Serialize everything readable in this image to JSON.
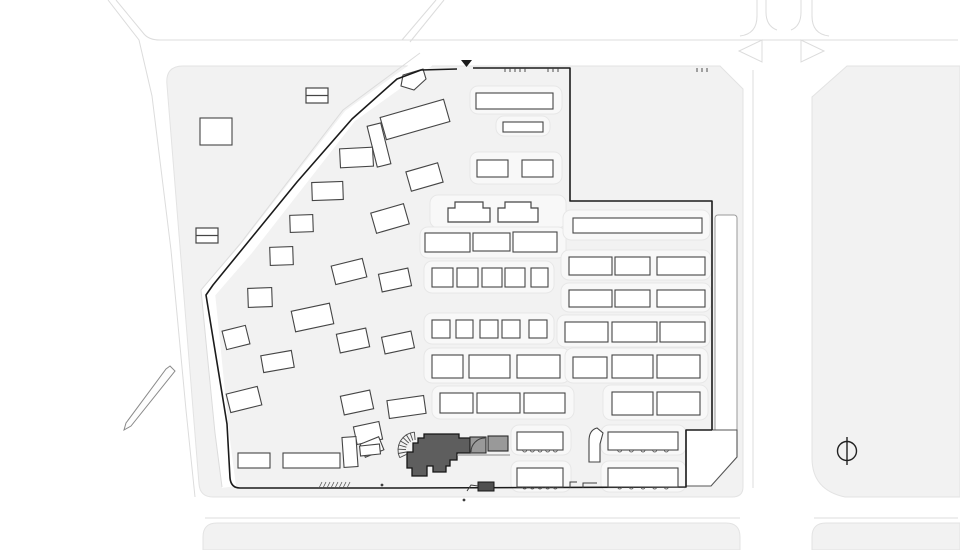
{
  "title": "architectural site plan",
  "colors": {
    "background": "#ffffff",
    "block": "#f2f2f2",
    "block_edge": "#e3e3e3",
    "corridor": "#f8f8f8",
    "corridor_edge": "#e7e7e7",
    "road_edge": "#dcdcdc",
    "building_fill": "#ffffff",
    "building_stroke": "#454545",
    "parcel_stroke": "#9a9a9a",
    "boundary": "#1b1b1b",
    "highlight_fill": "#5e5e5e",
    "highlight_stroke": "#161616",
    "annex_fill": "#999999",
    "detail": "#3d3d3d",
    "north": "#222222"
  },
  "plan": {
    "canvas": {
      "w": 960,
      "h": 550
    },
    "blocks": [
      "M183,66 H720 L743,89 V487 Q743,497 732,497 H213 Q200,497 199,484 L167,85 Q165,66 183,66 Z",
      "M847,66 L812,97 V458 Q812,490 845,497 H960 V66 Z",
      "M203,550 V537 Q203,523 217,523 H726 Q740,523 740,537 V550 Z",
      "M812,550 V537 Q812,523 826,523 H960 V550 Z"
    ],
    "diag_road": {
      "band": "M428,60 L350,116 L247,248 L208,293 L214,352 L222,432 L229,487",
      "curb": "M420,53 L343,110 L240,244 L201,290 L207,352 L215,433 L222,487"
    },
    "road_lines": [
      "M116,0 L144,34 Q149,40 160,40 L958,40",
      "M108,0 L139,40 L152,96 L171,250 L186,410 L195,497",
      "M436,0 L402,40",
      "M444,0 L410,42",
      "M757,0 V16 Q757,34 740,36",
      "M812,0 V16 Q812,34 829,36",
      "M766,0 V12 Q766,26 777,30",
      "M801,0 V12 Q801,26 791,30",
      "M753,70 V488",
      "M205,518 H740",
      "M814,518 H958"
    ],
    "islands": [
      "762,40 762,62 739,51",
      "801,40 801,62 824,51"
    ],
    "corridors": [
      [
        470,
        86,
        92,
        28
      ],
      [
        496,
        116,
        54,
        20
      ],
      [
        470,
        152,
        92,
        32
      ],
      [
        430,
        195,
        136,
        33
      ],
      [
        420,
        227,
        146,
        31
      ],
      [
        424,
        261,
        130,
        32
      ],
      [
        424,
        313,
        130,
        31
      ],
      [
        424,
        348,
        146,
        35
      ],
      [
        432,
        386,
        142,
        33
      ],
      [
        563,
        210,
        147,
        30
      ],
      [
        561,
        250,
        150,
        30
      ],
      [
        561,
        283,
        150,
        29
      ],
      [
        557,
        315,
        153,
        32
      ],
      [
        565,
        348,
        143,
        35
      ],
      [
        603,
        385,
        105,
        35
      ],
      [
        511,
        425,
        60,
        30
      ],
      [
        601,
        425,
        85,
        30
      ],
      [
        511,
        461,
        60,
        31
      ],
      [
        601,
        461,
        85,
        31
      ]
    ],
    "parcel_strip": [
      715,
      215,
      22,
      217
    ],
    "parcel_pentagon": "686,430 737,430 737,457 711,486 686,486",
    "wall_sliver": "170,366 175,371 131,426 124,430 126,423 166,369",
    "gate_building": "401,86 403,75 423,69 426,79 414,90",
    "hook_building": "M589,462 L589,441 Q589,430 597,428 L603,433 L600,444 L600,462 Z",
    "site_boundary": [
      "M421,70 L457,69",
      "M473,68 L570,68 L570,201 L712,201 L712,430",
      "M712,430 H686 V487 L400,488",
      "M400,488 L240,488 Q231,488 230,478 L227,424 L206,295 L213,285 L297,182 L352,119 L397,79 L421,70"
    ],
    "entrance_marker": "461,60 472,60 466.5,67",
    "boundary_ticks": [
      505,
      510,
      515,
      520,
      525,
      548,
      553,
      558,
      697,
      702,
      707
    ],
    "hatch": {
      "x": 322,
      "y": 482,
      "n": 8,
      "step": 4,
      "drop": 6
    },
    "jogs": [
      "M570,488 V482 H577",
      "M583,488 V483 H597"
    ],
    "buildings_grid": [
      [
        200,
        118,
        32,
        27
      ],
      [
        476,
        93,
        77,
        16
      ],
      [
        503,
        122,
        40,
        10
      ],
      [
        477,
        160,
        31,
        17
      ],
      [
        522,
        160,
        31,
        17
      ],
      [
        425,
        233,
        45,
        19
      ],
      [
        473,
        233,
        37,
        18
      ],
      [
        513,
        232,
        44,
        20
      ],
      [
        432,
        268,
        21,
        19
      ],
      [
        457,
        268,
        21,
        19
      ],
      [
        482,
        268,
        20,
        19
      ],
      [
        505,
        268,
        20,
        19
      ],
      [
        531,
        268,
        17,
        19
      ],
      [
        432,
        320,
        18,
        18
      ],
      [
        456,
        320,
        17,
        18
      ],
      [
        480,
        320,
        18,
        18
      ],
      [
        502,
        320,
        18,
        18
      ],
      [
        529,
        320,
        18,
        18
      ],
      [
        432,
        355,
        31,
        23
      ],
      [
        469,
        355,
        41,
        23
      ],
      [
        517,
        355,
        43,
        23
      ],
      [
        440,
        393,
        33,
        20
      ],
      [
        477,
        393,
        43,
        20
      ],
      [
        524,
        393,
        41,
        20
      ],
      [
        573,
        218,
        129,
        15
      ],
      [
        569,
        257,
        43,
        18
      ],
      [
        615,
        257,
        35,
        18
      ],
      [
        657,
        257,
        48,
        18
      ],
      [
        569,
        290,
        43,
        17
      ],
      [
        615,
        290,
        35,
        17
      ],
      [
        657,
        290,
        48,
        17
      ],
      [
        565,
        322,
        43,
        20
      ],
      [
        612,
        322,
        45,
        20
      ],
      [
        660,
        322,
        45,
        20
      ],
      [
        573,
        357,
        34,
        21
      ],
      [
        612,
        355,
        41,
        23
      ],
      [
        657,
        355,
        43,
        23
      ],
      [
        612,
        392,
        41,
        23
      ],
      [
        657,
        392,
        43,
        23
      ]
    ],
    "buildings_divided": [
      [
        306,
        88,
        22,
        15
      ],
      [
        196,
        228,
        22,
        15
      ]
    ],
    "buildings_notched": [
      [
        448,
        202,
        42,
        20
      ],
      [
        498,
        202,
        40,
        20
      ]
    ],
    "buildings_scalloped": [
      [
        517,
        432,
        46,
        18
      ],
      [
        608,
        432,
        70,
        18
      ],
      [
        517,
        468,
        46,
        19
      ],
      [
        608,
        468,
        70,
        19
      ]
    ],
    "buildings_angled": [
      [
        382,
        108,
        66,
        23,
        -16
      ],
      [
        372,
        124,
        14,
        42,
        -14
      ],
      [
        340,
        148,
        33,
        19,
        -3
      ],
      [
        312,
        182,
        31,
        18,
        -2
      ],
      [
        408,
        167,
        33,
        20,
        -16
      ],
      [
        373,
        208,
        34,
        21,
        -16
      ],
      [
        290,
        215,
        23,
        17,
        -2
      ],
      [
        270,
        247,
        23,
        18,
        -2
      ],
      [
        333,
        262,
        32,
        19,
        -14
      ],
      [
        380,
        271,
        30,
        18,
        -12
      ],
      [
        248,
        288,
        24,
        19,
        -2
      ],
      [
        293,
        307,
        39,
        21,
        -12
      ],
      [
        224,
        328,
        24,
        19,
        -14
      ],
      [
        338,
        331,
        30,
        19,
        -12
      ],
      [
        383,
        334,
        30,
        17,
        -12
      ],
      [
        262,
        353,
        31,
        17,
        -10
      ],
      [
        228,
        390,
        32,
        19,
        -14
      ],
      [
        342,
        393,
        30,
        19,
        -12
      ],
      [
        388,
        398,
        37,
        18,
        -8
      ],
      [
        355,
        424,
        26,
        18,
        -12
      ],
      [
        362,
        440,
        20,
        14,
        -22
      ],
      [
        343,
        437,
        14,
        30,
        -4
      ],
      [
        360,
        445,
        20,
        10,
        -6
      ],
      [
        238,
        453,
        32,
        15,
        0
      ],
      [
        283,
        453,
        57,
        15,
        0
      ]
    ],
    "highlight": {
      "outline": "M424,434 H459 V438 H470 V453 H457 V460 H450 V466 H446 V472 H433 V466 H427 V476 H412 V468 H407 V452 H413 V443 H418 V438 H424 Z",
      "annex": [
        [
          470,
          437,
          16,
          16
        ],
        [
          488,
          436,
          20,
          15
        ]
      ],
      "annex_arc": "M471,452 A14,14 0 0 1 485,438",
      "underline": "M457,455 H510",
      "outbuilding": [
        478,
        482,
        16,
        9
      ],
      "connector": "M467,491 L471,485 L478,486"
    },
    "fan": {
      "cx": 416,
      "cy": 450,
      "r1": 10,
      "r2": 18,
      "a1": 95,
      "a2": 205,
      "n": 8
    },
    "dots": [
      [
        382,
        485
      ],
      [
        464,
        500
      ]
    ],
    "north_arrow": {
      "cx": 847,
      "cy": 451,
      "r": 9.5,
      "line": [
        847,
        437,
        847,
        465
      ]
    }
  }
}
